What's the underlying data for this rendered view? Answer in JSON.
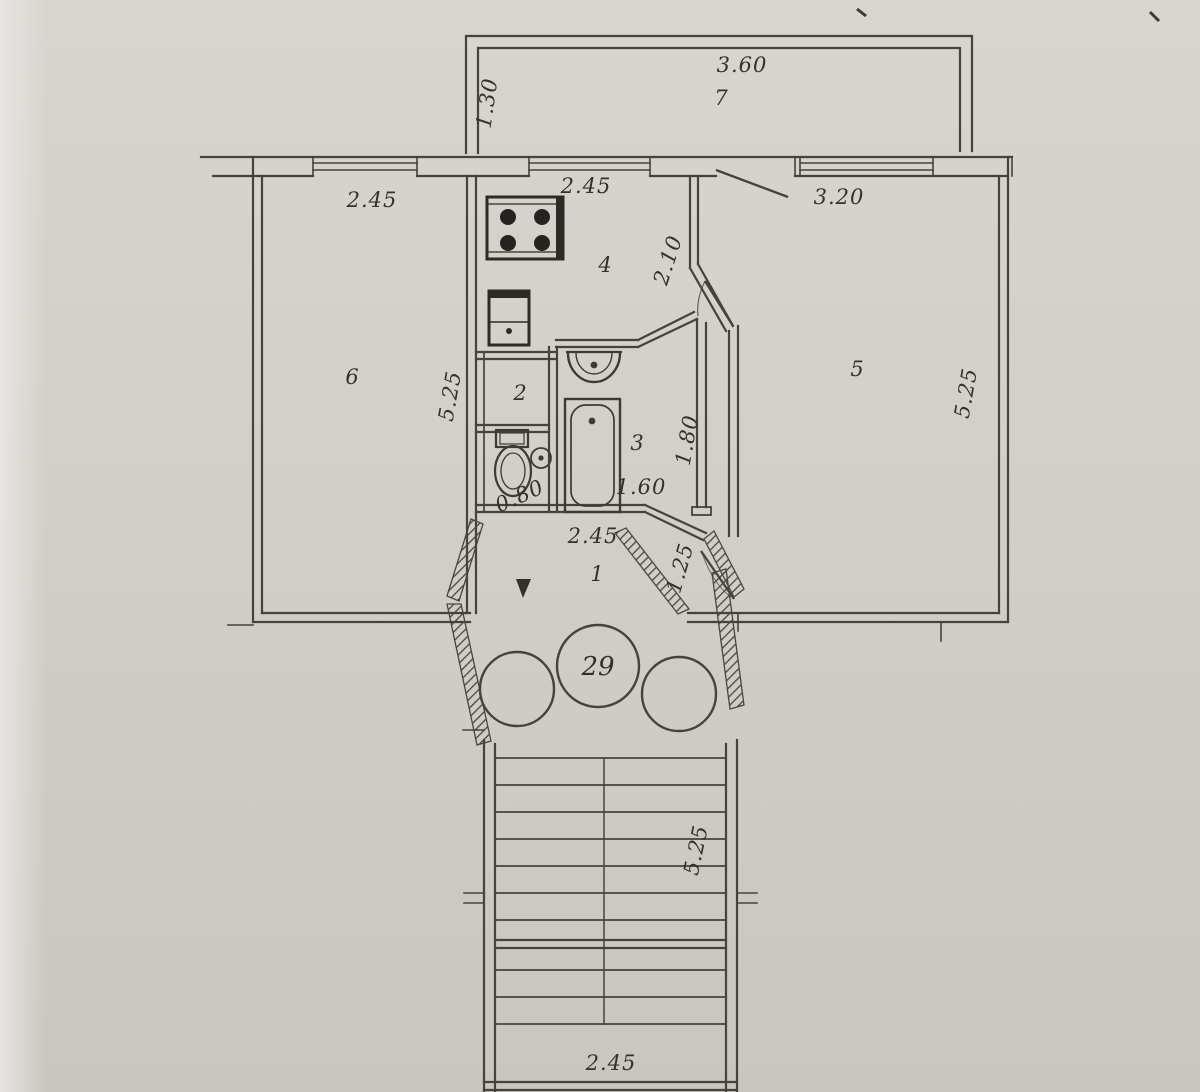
{
  "plan": {
    "apartment_number": "29",
    "rooms": {
      "balcony": "7",
      "kitchen": "4",
      "pantry": "2",
      "bathroom": "3",
      "hallway": "1",
      "room_left": "6",
      "room_right": "5"
    },
    "dimensions": {
      "balcony_width": "3.60",
      "balcony_depth": "1.30",
      "room_left_width": "2.45",
      "room_left_depth": "5.25",
      "kitchen_width": "2.45",
      "kitchen_depth": "2.10",
      "room_right_width": "3.20",
      "room_right_depth": "5.25",
      "bathroom_width": "1.60",
      "bathroom_depth": "1.80",
      "wc_width": "0.80",
      "hallway_width": "2.45",
      "corridor_depth": "1.25",
      "stairwell_depth": "5.25",
      "stairwell_width": "2.45"
    }
  }
}
